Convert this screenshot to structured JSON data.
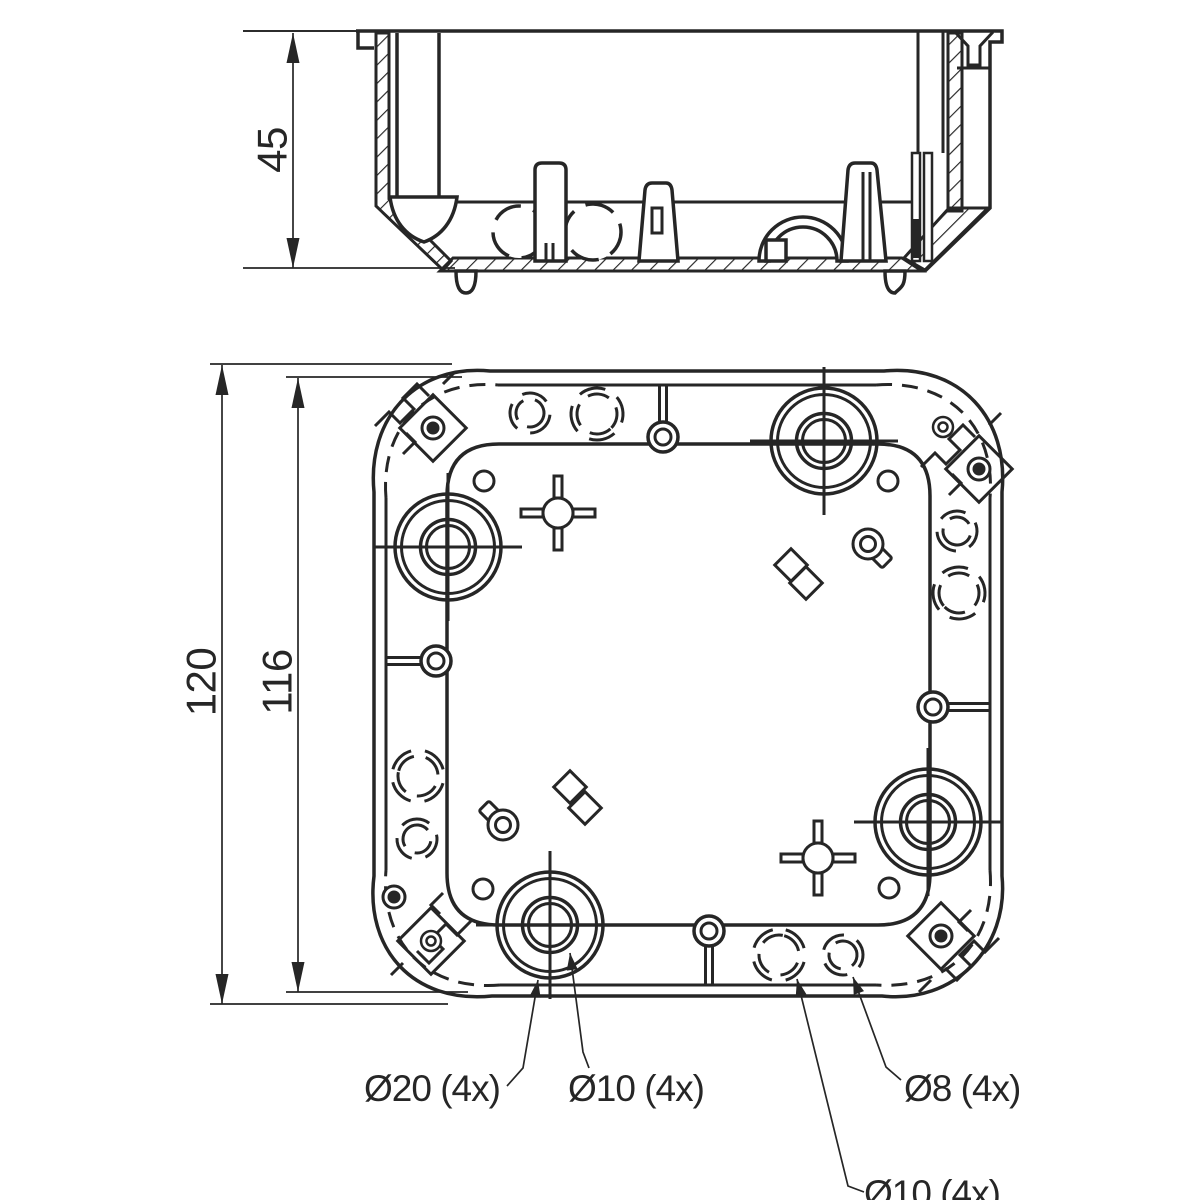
{
  "meta": {
    "background": "#ffffff",
    "line_color": "#262626"
  },
  "dimensions": {
    "section_height": {
      "text": "45"
    },
    "overall_size": {
      "text": "120"
    },
    "body_size": {
      "text": "116"
    }
  },
  "labels": {
    "knockout_20": {
      "text": "Ø20 (4x)"
    },
    "knockout_10_center": {
      "text": "Ø10 (4x)"
    },
    "knockout_8_wall": {
      "text": "Ø8 (4x)"
    },
    "knockout_10_wall": {
      "text": "Ø10 (4x)"
    }
  },
  "section": {
    "under": [
      {
        "k": "thin",
        "d": "M 243,31 H 356"
      },
      {
        "k": "hatch",
        "d": "M 376,33 H 389 V 199 L 451,261 L 443,270 L 376,206 Z"
      },
      {
        "k": "hatch",
        "d": "M 453,258 H 902 L 922,271 L 440,271 Z"
      },
      {
        "k": "hatch",
        "d": "M 948,33 H 962 V 211 H 948 Z"
      },
      {
        "k": "hatch",
        "d": "M 949,208 H 988 L 925,270 L 904,258 Z"
      },
      {
        "k": "med",
        "d": "M 455,202 H 913"
      },
      {
        "k": "main",
        "d": "M 397,33 V 197 M 439,33 V 197"
      },
      {
        "k": "med",
        "d": "M 955,32 L 968,46 V 65 H 980 V 46 L 993,32"
      },
      {
        "k": "med",
        "d": "M 957,68 H 991"
      },
      {
        "k": "med",
        "d": "M 918,31 V 153 M 943,31 V 153"
      }
    ],
    "knockout_circles": [
      {
        "cx": 519,
        "cy": 232,
        "r": 26,
        "rot": 18
      },
      {
        "cx": 593,
        "cy": 232,
        "r": 28,
        "rot": -10
      }
    ],
    "over": [
      {
        "k": "white",
        "d": "M 390,197 H 457 C 454,221 441,236 424,242 C 406,236 393,221 390,197 Z"
      },
      {
        "k": "white",
        "d": "M 535,170 Q 535,163 542,163 H 559 Q 566,163 566,170 V 261 H 535 Z"
      },
      {
        "k": "med",
        "d": "M 546,243 V 260 M 553,243 V 260"
      },
      {
        "k": "white",
        "d": "M 645,190 Q 646,183 652,183 H 666 Q 671,183 672,190 L 678,261 H 639 Z"
      },
      {
        "k": "med",
        "d": "M 652,208 H 662 V 233 H 652 Z"
      },
      {
        "k": "white",
        "d": "M 759,261 A 44,44 0 0 1 847,261 L 837,261 A 34,34 0 0 0 769,261 Z"
      },
      {
        "k": "white",
        "d": "M 766,240 H 786 V 261 H 766 Z"
      },
      {
        "k": "white",
        "d": "M 848,170 Q 849,163 855,163 H 871 Q 876,163 877,170 L 886,261 H 841 Z"
      },
      {
        "k": "med",
        "d": "M 863,172 V 261 M 870,172 V 261"
      },
      {
        "k": "white2",
        "d": "M 912,153 H 920 V 261 H 912 Z M 924,153 H 932 V 261 H 924 Z"
      },
      {
        "k": "dark",
        "d": "M 913,219 H 919 V 258 H 913 Z"
      },
      {
        "k": "white",
        "d": "M 456,271 C 456,287 460,293 466,293 C 472,293 476,287 476,271 Z"
      },
      {
        "k": "white",
        "d": "M 885,271 C 885,287 889,293 895,293 C 901,287 905,287 905,271 Z"
      },
      {
        "k": "main",
        "d": "M 356,31 H 1002 V 42 H 990 V 208 L 925,271"
      },
      {
        "k": "main",
        "d": "M 358,31 V 48 H 374"
      }
    ],
    "dim": {
      "line": [
        293,
        33,
        293,
        268
      ],
      "ext": [
        [
          243,
          31,
          356,
          31
        ],
        [
          243,
          268,
          455,
          268
        ]
      ],
      "arrows": [
        [
          293,
          33,
          -90
        ],
        [
          293,
          268,
          90
        ]
      ]
    }
  },
  "plan": {
    "outline_outer": "M 490,371 H 884 C 962,364 1009,420 1002,492 V 876 C 1009,948 954,1004 882,996 H 492 C 412,1004 365,948 374,876 V 492 C 367,420 414,364 490,371 Z",
    "band_edges": [
      "M 498,385 H 876",
      "M 990,498 V 870",
      "M 876,985 H 500",
      "M 386,870 V 498"
    ],
    "band_corners": [
      "M 876,385 C 948,379 996,426 990,498",
      "M 990,870 C 996,942 948,990 876,985",
      "M 500,985 C 426,991 380,942 386,870",
      "M 386,498 C 380,426 428,379 498,385"
    ],
    "interior": "M 499,444 H 878 Q 930,444 930,496 V 873 Q 930,925 878,925 H 499 Q 447,925 447,873 V 496 Q 447,444 499,444 Z",
    "wall_knockouts": [
      {
        "cx": 530,
        "cy": 413,
        "r": 20,
        "rot": 12
      },
      {
        "cx": 597,
        "cy": 414,
        "r": 26,
        "rot": 48
      },
      {
        "cx": 957,
        "cy": 531,
        "r": 20,
        "rot": 100
      },
      {
        "cx": 959,
        "cy": 593,
        "r": 26,
        "rot": 140
      },
      {
        "cx": 418,
        "cy": 776,
        "r": 26,
        "rot": 195
      },
      {
        "cx": 417,
        "cy": 839,
        "r": 20,
        "rot": 230
      },
      {
        "cx": 779,
        "cy": 955,
        "r": 26,
        "rot": 285
      },
      {
        "cx": 843,
        "cy": 955,
        "r": 20,
        "rot": 320
      }
    ],
    "knockouts": [
      {
        "cx": 824,
        "cy": 441
      },
      {
        "cx": 448,
        "cy": 547
      },
      {
        "cx": 550,
        "cy": 925
      },
      {
        "cx": 928,
        "cy": 822
      }
    ],
    "knockout_radii": [
      53,
      46.5,
      27.5,
      21.5
    ],
    "crosshair_extension": 74,
    "eyelets": [
      {
        "cx": 663,
        "cy": 437,
        "stems": [
          [
            659.5,
            385,
            659.5,
            423
          ],
          [
            666.5,
            385,
            666.5,
            423
          ]
        ]
      },
      {
        "cx": 436,
        "cy": 661,
        "stems": [
          [
            386,
            657.5,
            421,
            657.5
          ],
          [
            386,
            664.5,
            421,
            664.5
          ]
        ]
      },
      {
        "cx": 933,
        "cy": 707,
        "stems": [
          [
            948,
            703.5,
            990,
            703.5
          ],
          [
            948,
            710.5,
            990,
            710.5
          ]
        ]
      },
      {
        "cx": 709,
        "cy": 931,
        "stems": [
          [
            705.5,
            946,
            705.5,
            986
          ],
          [
            712.5,
            946,
            712.5,
            986
          ]
        ]
      }
    ],
    "small_holes": [
      {
        "cx": 484,
        "cy": 481
      },
      {
        "cx": 888,
        "cy": 481
      },
      {
        "cx": 483,
        "cy": 889
      },
      {
        "cx": 889,
        "cy": 888
      }
    ],
    "crosses": [
      {
        "cx": 558,
        "cy": 513
      },
      {
        "cx": 818,
        "cy": 858
      }
    ],
    "keyholes": [
      {
        "cx": 868,
        "cy": 544,
        "angle": 45
      },
      {
        "cx": 503,
        "cy": 825,
        "angle": 225
      }
    ],
    "diamonds": [
      {
        "cx": 791,
        "cy": 565
      },
      {
        "cx": 806,
        "cy": 583
      },
      {
        "cx": 570,
        "cy": 787
      },
      {
        "cx": 585,
        "cy": 808
      }
    ],
    "clips": [
      {
        "frame": [
          433,
          428
        ],
        "ring_filled": [
          433,
          428
        ],
        "zig": [
          433,
          428
        ],
        "rot": 0
      },
      {
        "frame": [
          979,
          469
        ],
        "ring_filled": [
          979,
          469
        ],
        "ring_open": [
          943,
          427
        ],
        "zig": [
          979,
          469
        ],
        "rot": 0
      },
      {
        "frame": [
          431,
          941
        ],
        "ring_filled": [
          394,
          897
        ],
        "ring_open": [
          431,
          941
        ],
        "zig": [
          413,
          919
        ],
        "rot": 180
      },
      {
        "frame": [
          941,
          936
        ],
        "ring_filled": [
          941,
          936
        ],
        "zig": [
          941,
          936
        ],
        "rot": 180
      }
    ],
    "dims": [
      {
        "line": [
          222,
          365,
          222,
          1004
        ],
        "ext": [
          [
            210,
            364,
            452,
            364
          ],
          [
            210,
            1004,
            448,
            1004
          ]
        ],
        "arrows": [
          [
            222,
            365,
            -90
          ],
          [
            222,
            1004,
            90
          ]
        ]
      },
      {
        "line": [
          298,
          378,
          298,
          992
        ],
        "ext": [
          [
            286,
            377,
            462,
            377
          ],
          [
            286,
            992,
            468,
            992
          ]
        ],
        "arrows": [
          [
            298,
            378,
            -90
          ],
          [
            298,
            992,
            90
          ]
        ]
      }
    ],
    "leaders": [
      {
        "pts": [
          [
            507,
            1086
          ],
          [
            523,
            1068
          ],
          [
            538,
            980
          ]
        ]
      },
      {
        "pts": [
          [
            589,
            1068
          ],
          [
            583,
            1052
          ],
          [
            570,
            953
          ]
        ]
      },
      {
        "pts": [
          [
            901,
            1080
          ],
          [
            886,
            1067
          ],
          [
            853,
            977
          ]
        ]
      },
      {
        "pts": [
          [
            864,
            1192
          ],
          [
            848,
            1186
          ],
          [
            797,
            979
          ]
        ]
      }
    ]
  }
}
